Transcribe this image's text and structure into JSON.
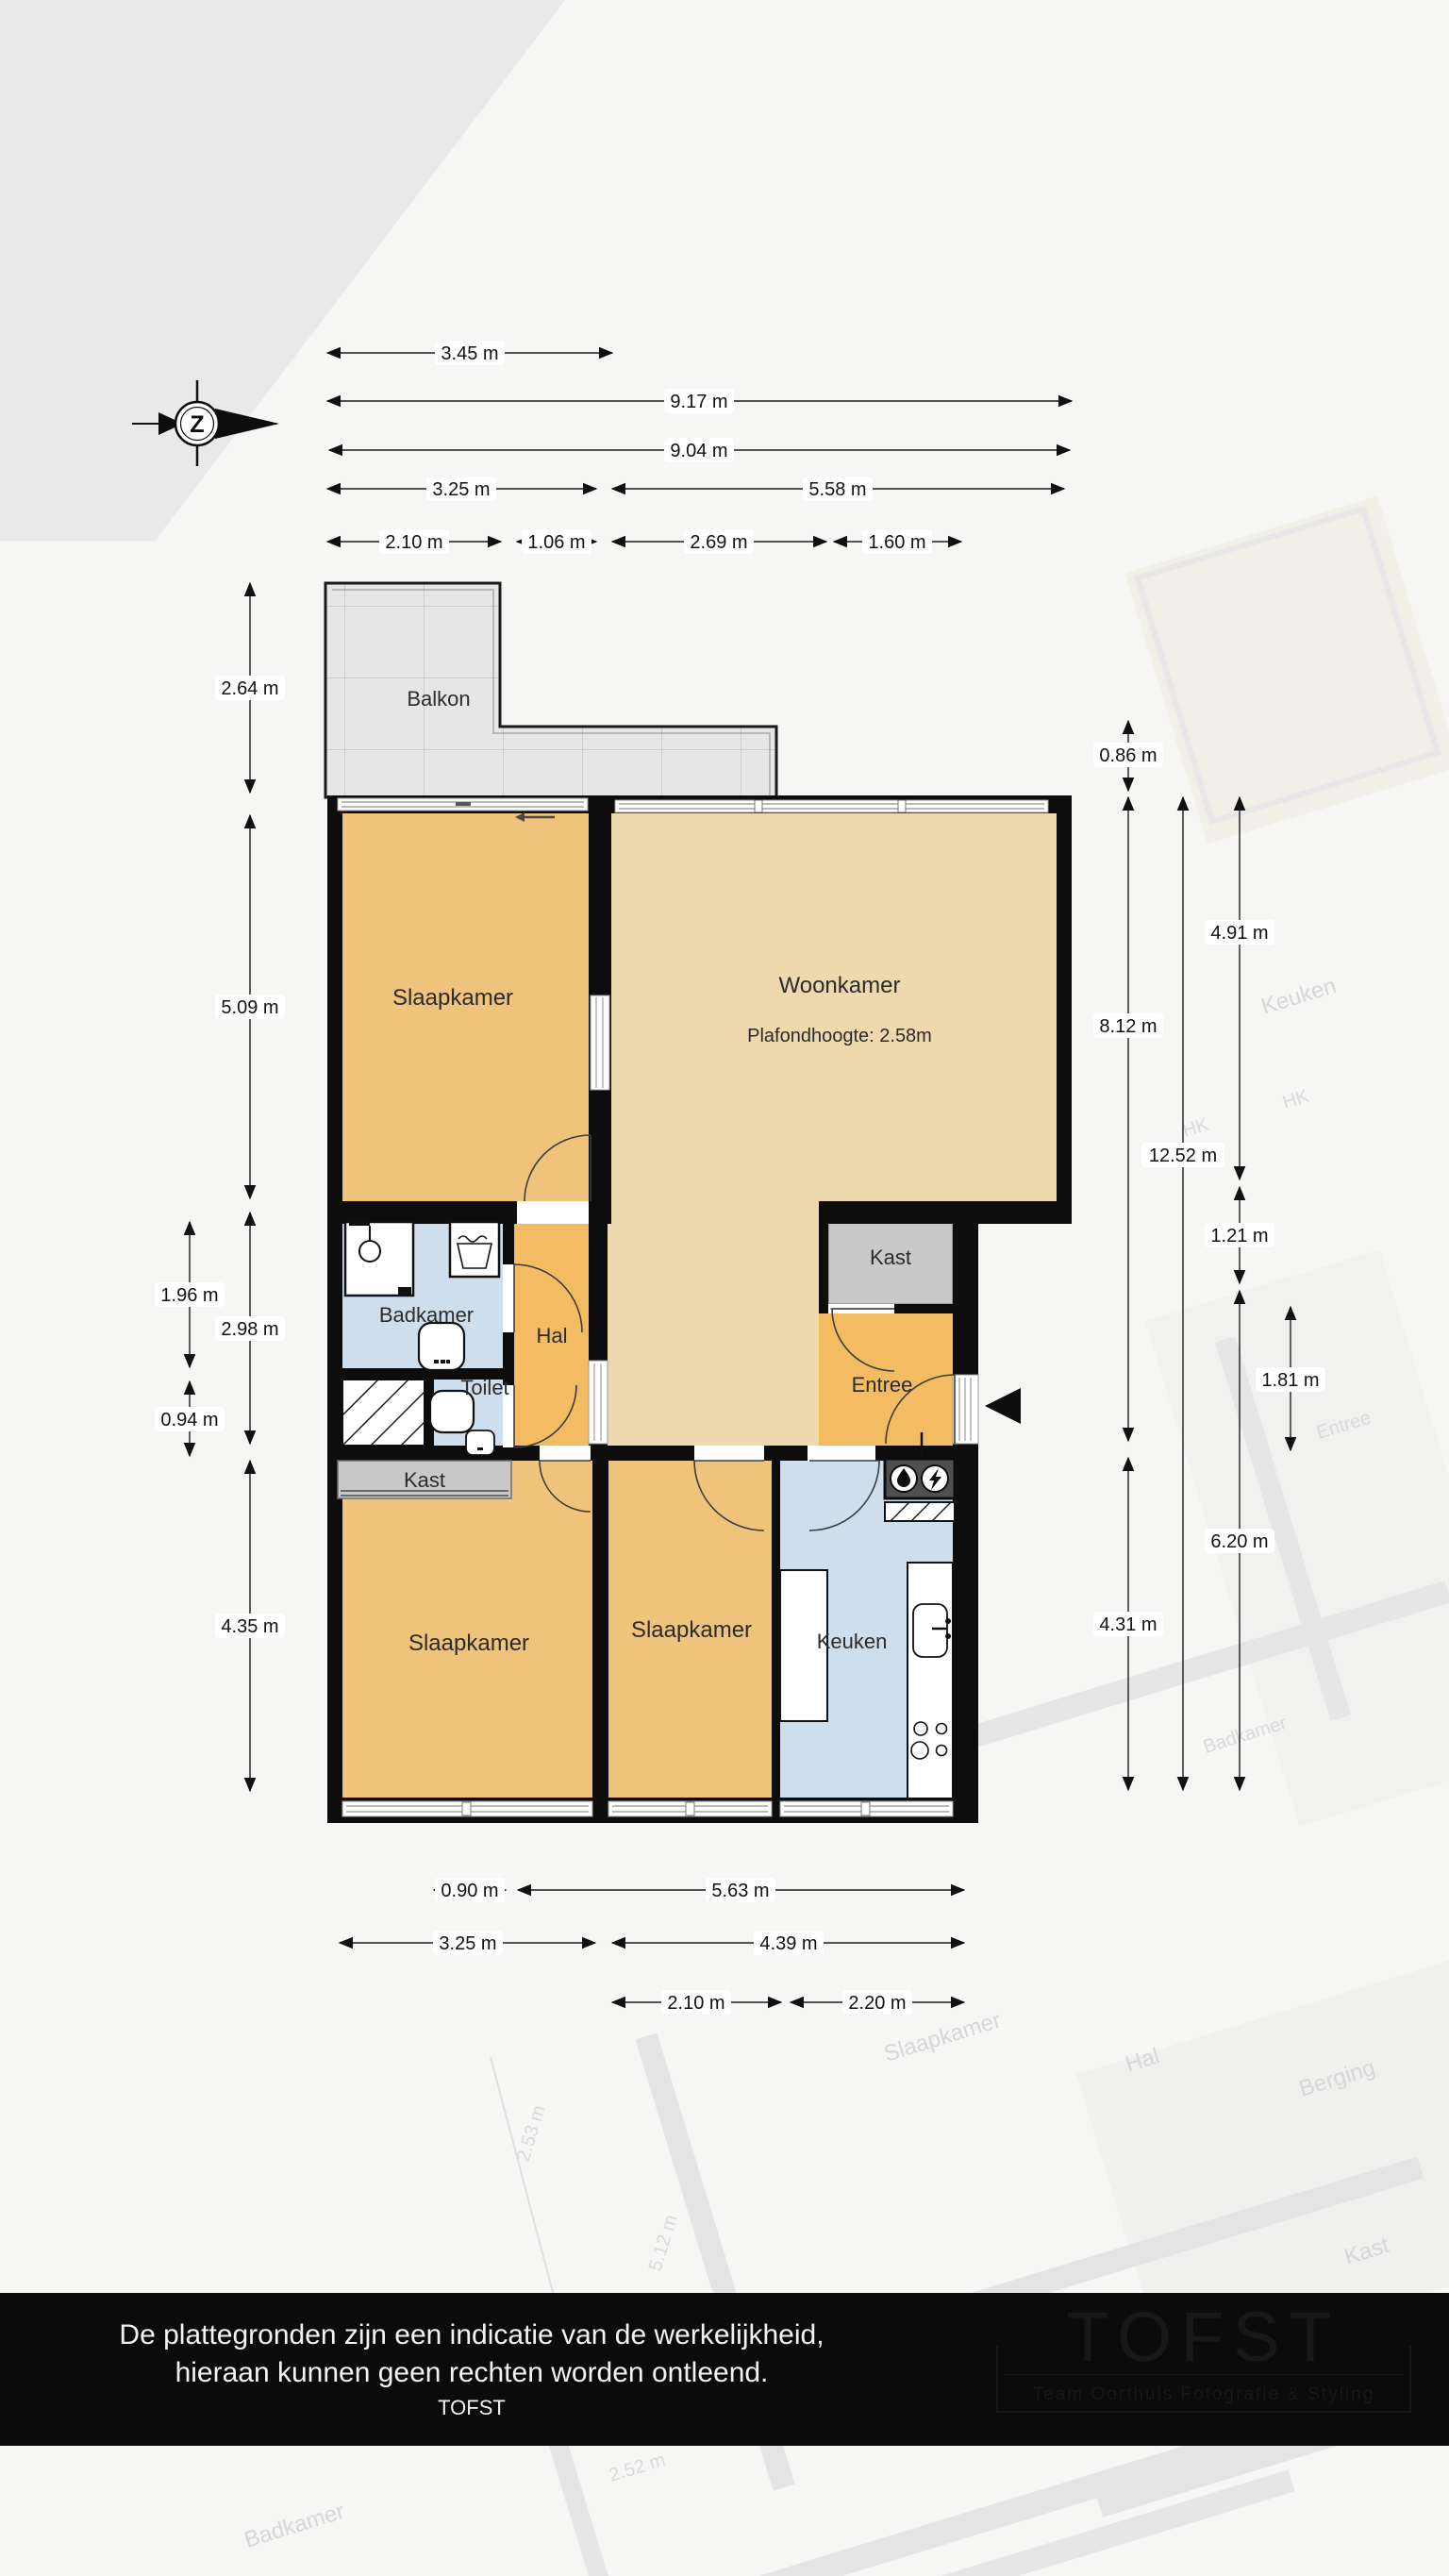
{
  "compass": {
    "letter": "Z"
  },
  "rooms": {
    "balkon": "Balkon",
    "slaapkamer1": "Slaapkamer",
    "woonkamer": "Woonkamer",
    "woonkamer_sub": "Plafondhoogte: 2.58m",
    "badkamer": "Badkamer",
    "toilet": "Toilet",
    "hal": "Hal",
    "kast1": "Kast",
    "kast2": "Kast",
    "entree": "Entree",
    "slaapkamer2": "Slaapkamer",
    "slaapkamer3": "Slaapkamer",
    "keuken": "Keuken"
  },
  "dims": {
    "top1": "3.45 m",
    "top2": "9.17 m",
    "top3": "9.04 m",
    "top4a": "3.25 m",
    "top4b": "5.58 m",
    "top5a": "2.10 m",
    "top5b": "1.06 m",
    "top5c": "2.69 m",
    "top5d": "1.60 m",
    "left1": "2.64 m",
    "left2": "5.09 m",
    "left3": "1.96 m",
    "left4": "2.98 m",
    "left5": "0.94 m",
    "left6": "4.35 m",
    "right1": "0.86 m",
    "right2": "8.12 m",
    "right3": "12.52 m",
    "right4": "4.91 m",
    "right5": "1.21 m",
    "right6": "1.81 m",
    "right7": "6.20 m",
    "right8": "4.31 m",
    "bottom1a": "0.90 m",
    "bottom1b": "5.63 m",
    "bottom2a": "3.25 m",
    "bottom2b": "4.39 m",
    "bottom3a": "2.10 m",
    "bottom3b": "2.20 m"
  },
  "watermark": {
    "t1": "Slaapkamer",
    "t2": "Hal",
    "t3": "Berging",
    "t4": "Kast",
    "t5": "Badkamer",
    "t6": "2.52 m",
    "t7": "2.53 m",
    "t8": "5.12 m",
    "t9": "Keuken",
    "t10": "HK",
    "t11": "HK",
    "t12": "Entree",
    "t13": "Badkamer"
  },
  "footer": {
    "line1": "De plattegronden zijn een indicatie van de werkelijkheid,",
    "line2": "hieraan kunnen geen rechten worden ontleend.",
    "line3": "TOFST",
    "logo_title": "TOFST",
    "logo_subtitle": "Team Oorthuis Fotografie & Styling"
  },
  "colors": {
    "bedroom": "#f0c37c",
    "hall": "#f4bc62",
    "living": "#edd9ad",
    "wet": "#cfdeed",
    "closet": "#c9c9c9",
    "wall": "#0d0d0d",
    "balcony": "#e6e6e6"
  }
}
